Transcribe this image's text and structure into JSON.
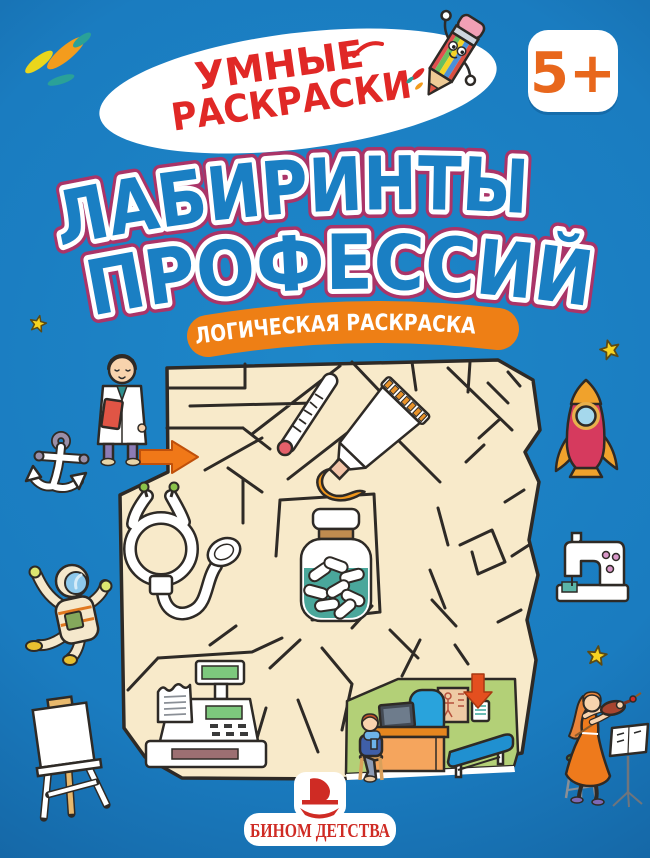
{
  "cover": {
    "series_badge": {
      "line1": "УМНЫЕ",
      "line2": "РАСКРАСКИ"
    },
    "age_badge": {
      "label": "5+"
    },
    "title": {
      "line1": "ЛАБИРИНТЫ",
      "line2": "ПРОФЕССИЙ"
    },
    "subtitle": {
      "label": "ЛОГИЧЕСКАЯ РАСКРАСКА"
    },
    "publisher": {
      "name": "БИНОМ ДЕТСТВА"
    }
  },
  "colors": {
    "background_blue": "#1a7fc3",
    "series_text_red": "#e02826",
    "age_badge_orange": "#e8671c",
    "title_fill_blue": "#1a7fc3",
    "title_outline_white": "#ffffff",
    "title_keyline_magenta": "#aa3468",
    "subtitle_pill_orange": "#ee7f15",
    "maze_paper_beige": "#f8eaca",
    "maze_wall_dark": "#2e2a26",
    "publisher_red": "#cf2b24",
    "star_yellow": "#f6d321"
  },
  "illustrations": [
    {
      "name": "pencil-mascot",
      "label": "striped pencil character"
    },
    {
      "name": "doctor",
      "label": "doctor in white coat"
    },
    {
      "name": "anchor",
      "label": "white anchor"
    },
    {
      "name": "astronaut",
      "label": "floating astronaut"
    },
    {
      "name": "easel",
      "label": "artist easel"
    },
    {
      "name": "rocket",
      "label": "red rocket"
    },
    {
      "name": "sewing-machine",
      "label": "sewing machine"
    },
    {
      "name": "violinist",
      "label": "violinist with music stand"
    },
    {
      "name": "maze",
      "label": "beige maze"
    },
    {
      "name": "thermometer",
      "label": "thermometer"
    },
    {
      "name": "toothpaste-tube",
      "label": "toothpaste tube"
    },
    {
      "name": "pills-bottle",
      "label": "bottle of pills"
    },
    {
      "name": "stethoscope",
      "label": "stethoscope"
    },
    {
      "name": "cash-register",
      "label": "cash register"
    },
    {
      "name": "doctors-office",
      "label": "doctor's office scene"
    },
    {
      "name": "entrance-arrow",
      "label": "orange maze entrance arrow"
    },
    {
      "name": "exit-arrow",
      "label": "red maze exit arrow"
    },
    {
      "name": "stars",
      "label": "yellow stars"
    }
  ]
}
